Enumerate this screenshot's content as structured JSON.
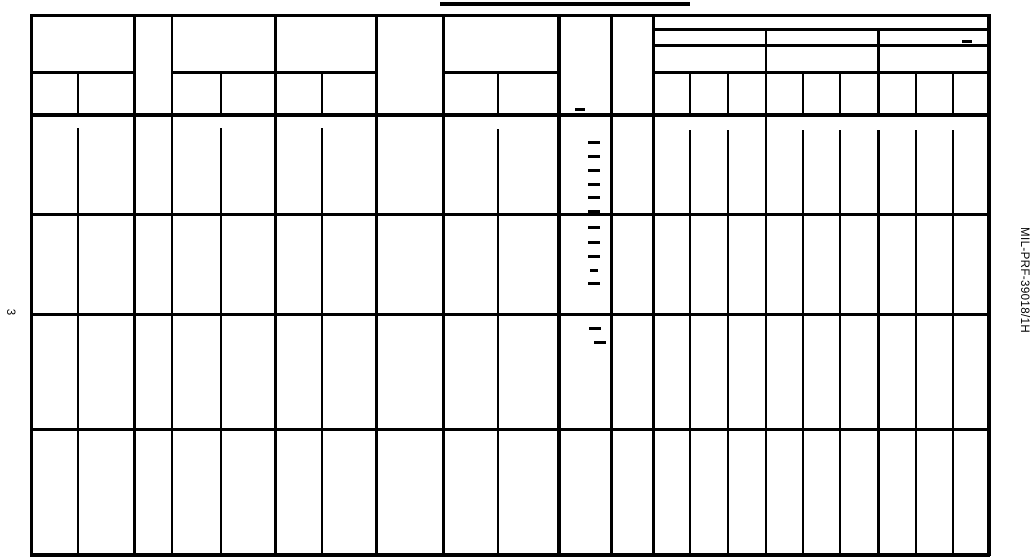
{
  "page": {
    "background_color": "#ffffff",
    "ink_color": "#000000",
    "page_number": "3",
    "spec_number": "MIL-PRF-39018/1H"
  },
  "table": {
    "title_underline": {
      "x": 440,
      "y": 2,
      "w": 250,
      "h": 3.5
    },
    "grid": {
      "vlines": [
        {
          "x": 30,
          "w": 3,
          "segs": [
            [
              14,
              553
            ]
          ]
        },
        {
          "x": 77,
          "w": 2,
          "segs": [
            [
              71,
              114
            ],
            [
              128,
              553
            ]
          ]
        },
        {
          "x": 133,
          "w": 3,
          "segs": [
            [
              14,
              553
            ]
          ]
        },
        {
          "x": 171,
          "w": 2,
          "segs": [
            [
              14,
              553
            ]
          ]
        },
        {
          "x": 220,
          "w": 2,
          "segs": [
            [
              71,
              114
            ],
            [
              128,
              553
            ]
          ]
        },
        {
          "x": 274,
          "w": 3,
          "segs": [
            [
              14,
              553
            ]
          ]
        },
        {
          "x": 321,
          "w": 2,
          "segs": [
            [
              71,
              114
            ],
            [
              128,
              553
            ]
          ]
        },
        {
          "x": 375,
          "w": 3,
          "segs": [
            [
              14,
              553
            ]
          ]
        },
        {
          "x": 442,
          "w": 2.5,
          "segs": [
            [
              14,
              553
            ]
          ]
        },
        {
          "x": 497,
          "w": 1.6,
          "segs": [
            [
              71,
              114
            ],
            [
              129,
              553
            ]
          ]
        },
        {
          "x": 557,
          "w": 3.5,
          "segs": [
            [
              14,
              553
            ]
          ]
        },
        {
          "x": 610,
          "w": 3,
          "segs": [
            [
              14,
              553
            ]
          ]
        },
        {
          "x": 652,
          "w": 3,
          "segs": [
            [
              14,
              553
            ]
          ]
        },
        {
          "x": 689,
          "w": 2,
          "segs": [
            [
              72,
              114
            ],
            [
              130,
              553
            ]
          ]
        },
        {
          "x": 727,
          "w": 2,
          "segs": [
            [
              72,
              114
            ],
            [
              130,
              553
            ]
          ]
        },
        {
          "x": 765,
          "w": 1.8,
          "segs": [
            [
              28,
              553
            ]
          ]
        },
        {
          "x": 802,
          "w": 2,
          "segs": [
            [
              72,
              114
            ],
            [
              130,
              553
            ]
          ]
        },
        {
          "x": 839,
          "w": 2,
          "segs": [
            [
              72,
              114
            ],
            [
              130,
              553
            ]
          ]
        },
        {
          "x": 877,
          "w": 2.5,
          "segs": [
            [
              28,
              114
            ],
            [
              130,
              553
            ]
          ]
        },
        {
          "x": 915,
          "w": 2,
          "segs": [
            [
              72,
              114
            ],
            [
              130,
              553
            ]
          ]
        },
        {
          "x": 952,
          "w": 1.8,
          "segs": [
            [
              72,
              114
            ],
            [
              130,
              553
            ]
          ]
        },
        {
          "x": 987,
          "w": 3.5,
          "segs": [
            [
              14,
              553
            ]
          ]
        }
      ],
      "hlines": [
        {
          "y": 14,
          "h": 3,
          "segs": [
            [
              30,
              987
            ]
          ]
        },
        {
          "y": 28,
          "h": 3,
          "segs": [
            [
              652,
              987
            ]
          ]
        },
        {
          "y": 44,
          "h": 2.5,
          "segs": [
            [
              652,
              987
            ]
          ]
        },
        {
          "y": 71,
          "h": 3,
          "segs": [
            [
              30,
              133
            ],
            [
              171,
              375
            ],
            [
              442,
              557
            ],
            [
              652,
              987
            ]
          ]
        },
        {
          "y": 113,
          "h": 3.5,
          "segs": [
            [
              30,
              987
            ]
          ]
        },
        {
          "y": 213,
          "h": 3,
          "segs": [
            [
              30,
              987
            ]
          ]
        },
        {
          "y": 313,
          "h": 3,
          "segs": [
            [
              30,
              987
            ]
          ]
        },
        {
          "y": 428,
          "h": 2.5,
          "segs": [
            [
              30,
              987
            ]
          ]
        },
        {
          "y": 553,
          "h": 3.5,
          "segs": [
            [
              30,
              987
            ]
          ]
        }
      ]
    },
    "dash_marks": [
      {
        "x": 575,
        "y": 108,
        "w": 10
      },
      {
        "x": 962,
        "y": 40,
        "w": 10
      },
      {
        "x": 588,
        "y": 141,
        "w": 12
      },
      {
        "x": 588,
        "y": 155,
        "w": 12
      },
      {
        "x": 588,
        "y": 169,
        "w": 12
      },
      {
        "x": 588,
        "y": 183,
        "w": 12
      },
      {
        "x": 588,
        "y": 196,
        "w": 12
      },
      {
        "x": 588,
        "y": 210,
        "w": 12
      },
      {
        "x": 588,
        "y": 226,
        "w": 12
      },
      {
        "x": 588,
        "y": 241,
        "w": 12
      },
      {
        "x": 588,
        "y": 255,
        "w": 12
      },
      {
        "x": 590,
        "y": 269,
        "w": 8
      },
      {
        "x": 588,
        "y": 282,
        "w": 12
      },
      {
        "x": 589,
        "y": 327,
        "w": 12
      },
      {
        "x": 594,
        "y": 341,
        "w": 12
      }
    ]
  }
}
